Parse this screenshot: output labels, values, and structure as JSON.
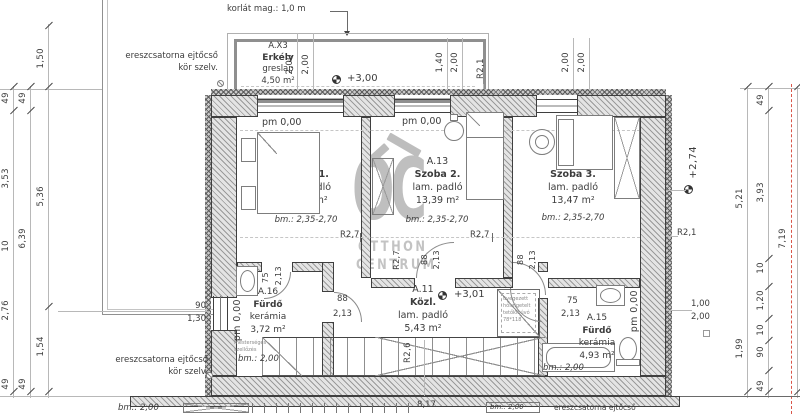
{
  "annotations": {
    "railing": "korlát mag.: 1,0 m",
    "downspout1": "ereszcsatorna ejtőcső",
    "downspout2": "kör szelv.",
    "roof_hatch": [
      "üvegezett",
      "hőszigetelt",
      "tetőkibúvó",
      "78*118"
    ],
    "vent1": "mesterséges",
    "vent2": "szellőzés"
  },
  "levels": {
    "pm": "pm 0,00",
    "balcony": "+3,00",
    "hall": "+3,01",
    "attic": "+2,74"
  },
  "rooms": {
    "balcony": {
      "id": "A.X3",
      "name": "Erkély",
      "finish": "greslap",
      "area": "4,50 m²"
    },
    "room1": {
      "id": "A.12",
      "name": "Szoba 1.",
      "finish": "lam. padló",
      "area": "14,75 m²",
      "height": "bm.: 2,35-2,70"
    },
    "room2": {
      "id": "A.13",
      "name": "Szoba 2.",
      "finish": "lam. padló",
      "area": "13,39 m²",
      "height": "bm.: 2,35-2,70"
    },
    "room3": {
      "id": "A.14",
      "name": "Szoba 3.",
      "finish": "lam. padló",
      "area": "13,47 m²",
      "height": "bm.: 2,35-2,70"
    },
    "bath1": {
      "id": "A.16",
      "name": "Fürdő",
      "finish": "kerámia",
      "area": "3,72 m²",
      "height": "bm.: 2,00"
    },
    "hall": {
      "id": "A.11",
      "name": "Közl.",
      "finish": "lam. padló",
      "area": "5,43 m²"
    },
    "bath2": {
      "id": "A.15",
      "name": "Fürdő",
      "finish": "kerámia",
      "area": "4,93 m²",
      "height": "bm.: 2,00"
    }
  },
  "dims": {
    "left_a": [
      "49",
      "3,53",
      "10",
      "2,76",
      "49"
    ],
    "left_b": [
      "49",
      "6,39",
      "49"
    ],
    "left_c": [
      "1,50",
      "5,36",
      "1,54"
    ],
    "right_a": [
      "5,21",
      "1,99"
    ],
    "right_b": [
      "49",
      "3,93",
      "10",
      "1,20",
      "10",
      "90",
      "49"
    ],
    "right_total": "7,19",
    "balcony_w": [
      "2,00",
      "2,00"
    ],
    "window2": [
      "1,40",
      "2,00"
    ],
    "window3": [
      "2,00",
      "2,00"
    ],
    "bath1_window": [
      "90",
      "1,30"
    ],
    "right_window": [
      "1,00",
      "2,00"
    ],
    "door_w": "88",
    "door_h": "2,13",
    "door_w2": "75",
    "r21": "R2,1",
    "r27": "R2,7",
    "r26": "R2,6",
    "stairs_run": "8,17",
    "bm200": "bm.: 2,00"
  },
  "watermark": {
    "logo": "OC",
    "line1": "OTTHON",
    "line2": "CENTRUM"
  },
  "colors": {
    "wall_line": "#3f3f3f",
    "hatch": "#9a9a9a",
    "red_dash": "#d9564a",
    "watermark": "#c0c0c0"
  }
}
